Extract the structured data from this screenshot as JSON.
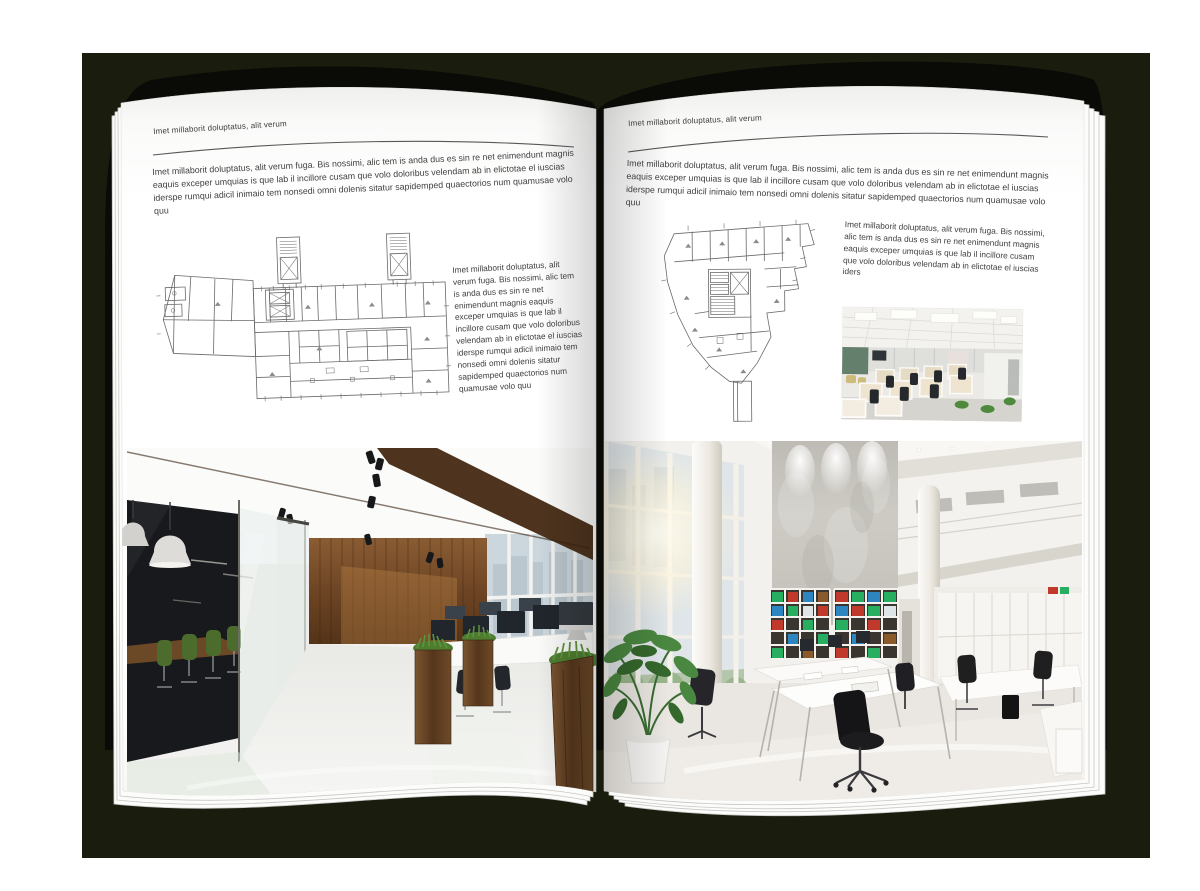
{
  "background_color": "#1a1c0e",
  "page_color": "#ffffff",
  "left_page": {
    "header": "Imet millaborit doluptatus, alit verum",
    "intro": "Imet millaborit doluptatus, alit verum fuga. Bis nossimi, alic tem is anda dus es sin re net enimendunt magnis eaquis exceper umquias is que lab il incillore cusam que volo doloribus velendam ab in elictotae el iuscias iderspe rumqui adicil inimaio tem nonsedi omni dolenis sitatur sapidemped quaectorios num quamusae volo quu",
    "caption": "Imet millaborit doluptatus, alit verum fuga. Bis nossimi, alic tem is anda dus es sin re net enimendunt magnis eaquis exceper umquias is que lab il incillore cusam que volo doloribus velendam ab in elictotae el iuscias iderspe rumqui adicil inimaio tem nonsedi omni dolenis sitatur sapidemped quaectorios num quamusae volo quu"
  },
  "right_page": {
    "header": "Imet millaborit doluptatus, alit verum",
    "intro": "Imet millaborit doluptatus, alit verum fuga. Bis nossimi, alic tem is anda dus es sin re net enimendunt magnis eaquis exceper umquias is que lab il incillore cusam que volo doloribus velendam ab in elictotae el iuscias iderspe rumqui adicil inimaio tem nonsedi omni dolenis sitatur sapidemped quaectorios num quamusae volo quu",
    "caption": "Imet millaborit doluptatus, alit verum fuga. Bis nossimi, alic tem is anda dus es sin re net enimendunt magnis eaquis exceper umquias is que lab il incillore cusam que volo doloribus velendam ab in elictotae el iuscias iders"
  }
}
